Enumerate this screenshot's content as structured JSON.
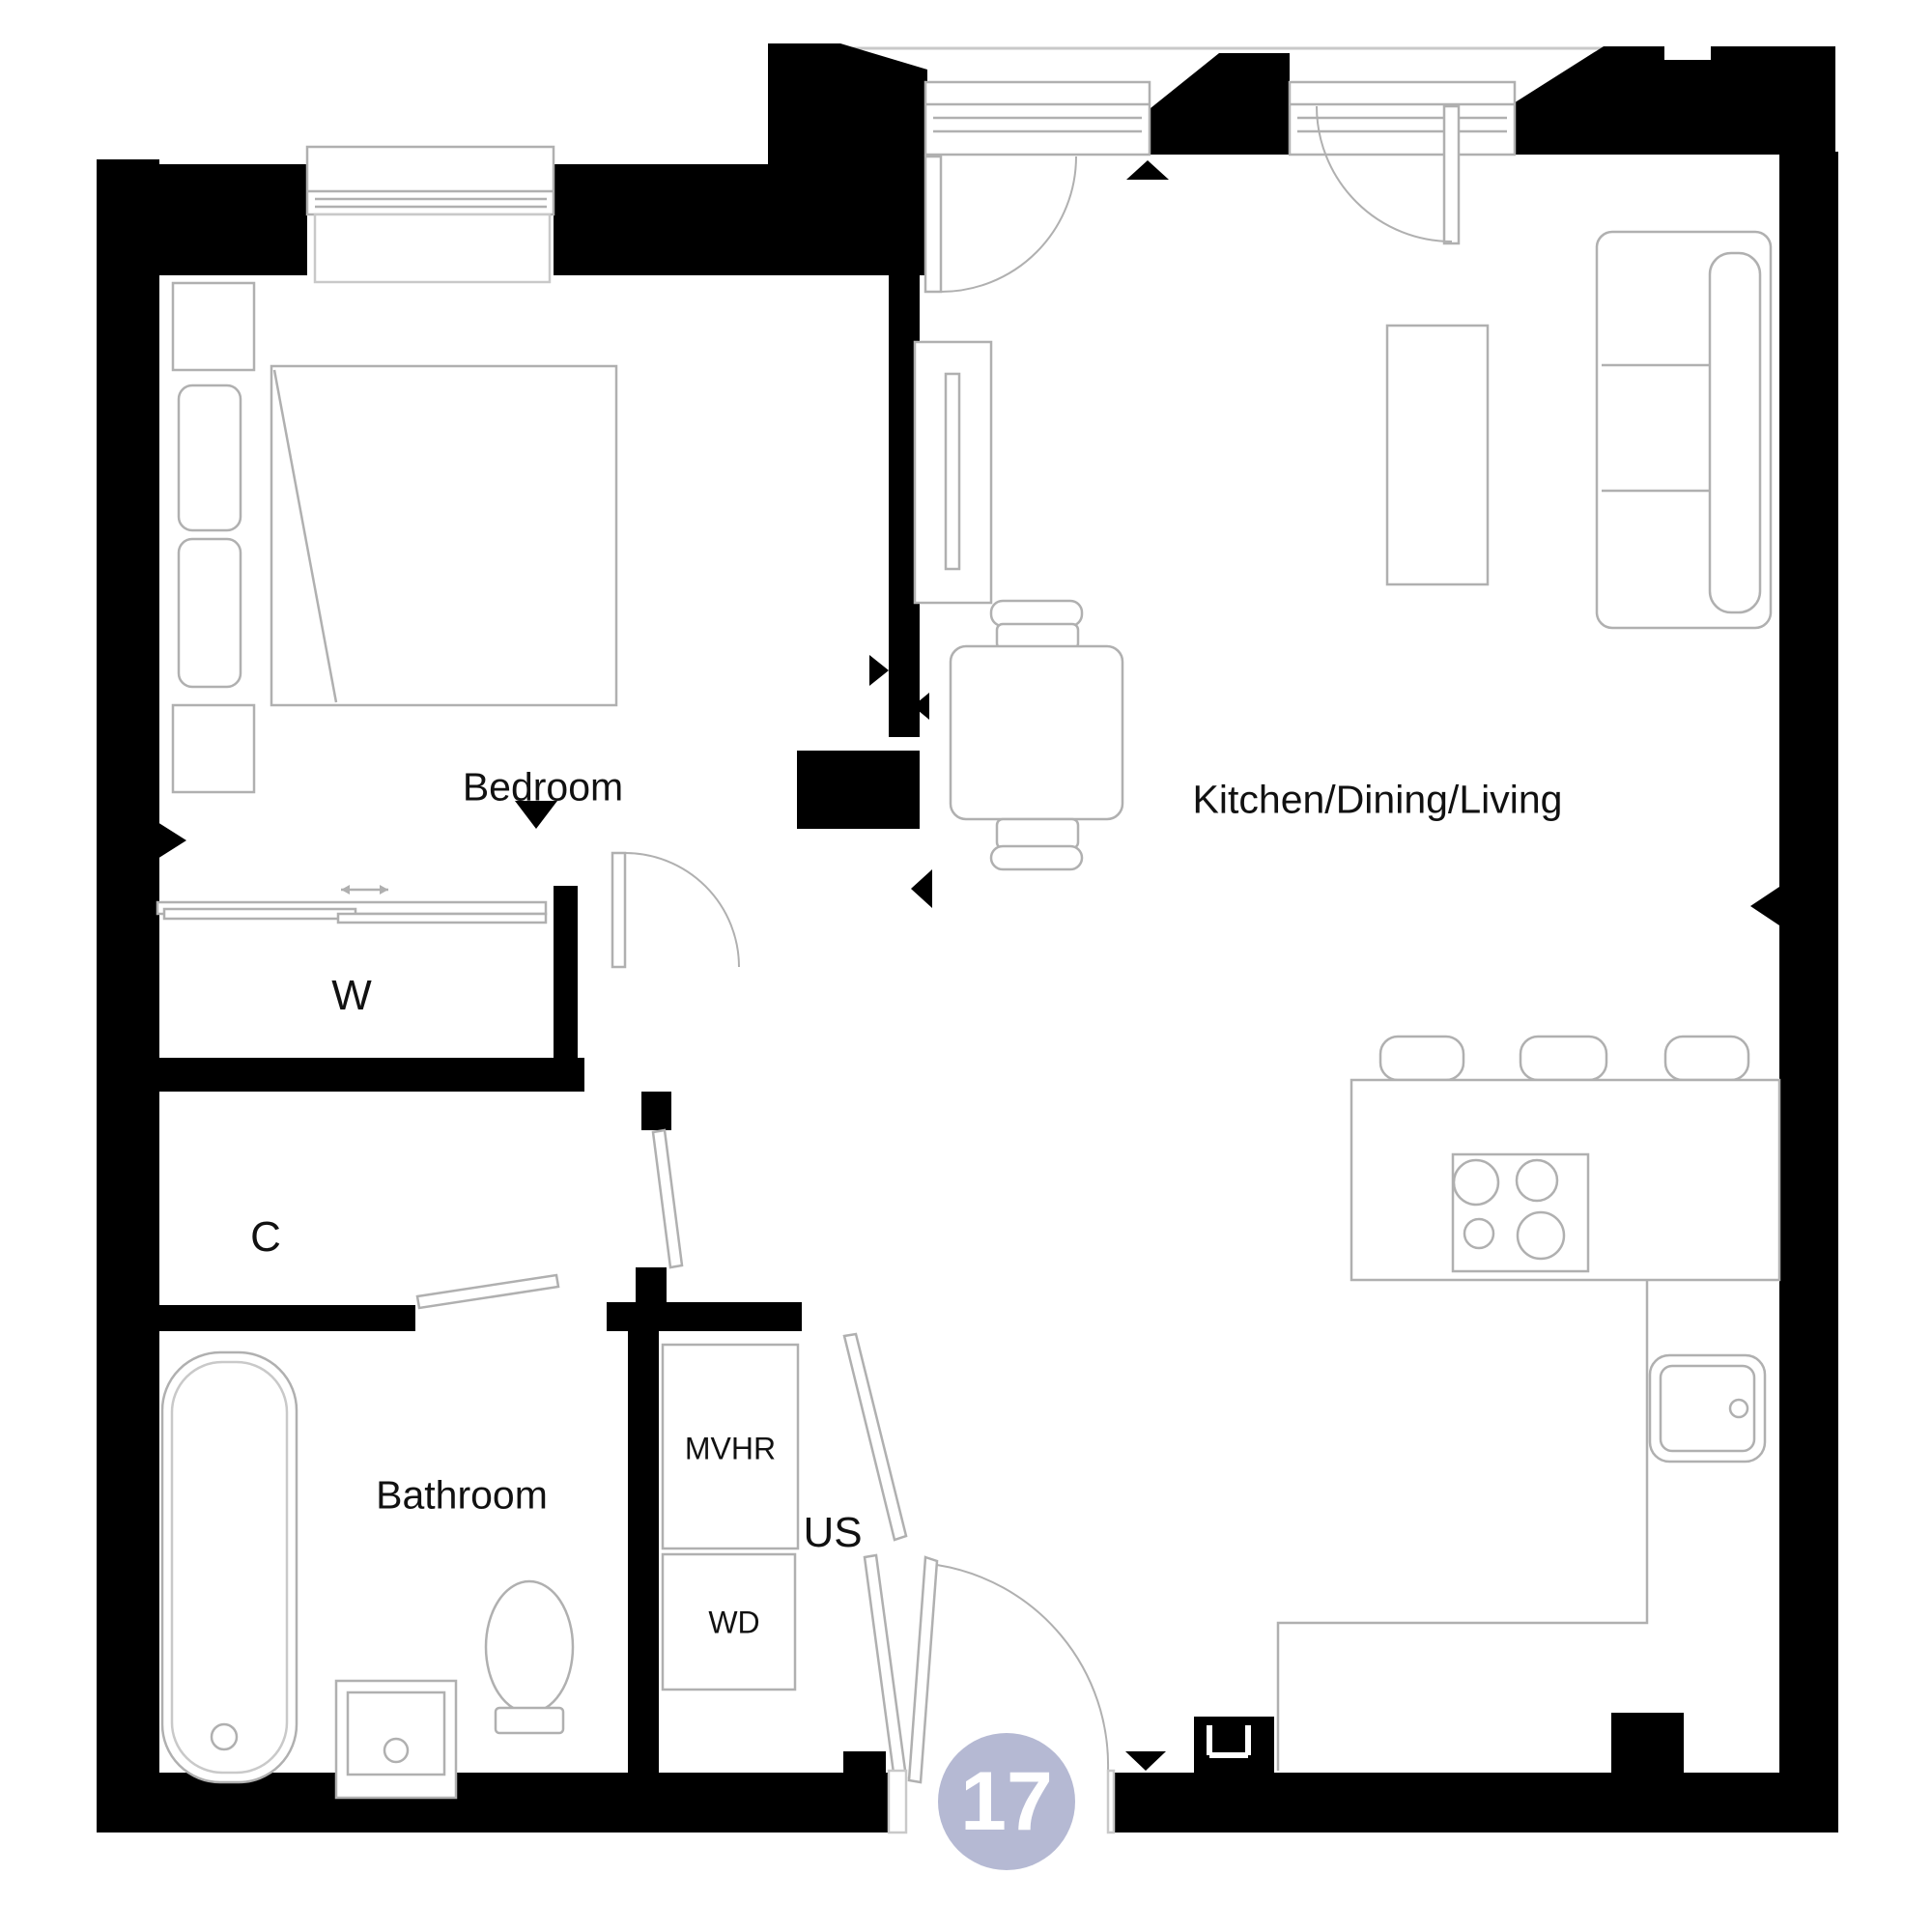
{
  "page": {
    "title": "Apartment floor plan",
    "background": "#ffffff"
  },
  "colors": {
    "wall": "#000000",
    "furniture_line": "#b0b0b0",
    "light_line": "#c9c9c9",
    "text": "#111111",
    "badge_fill": "#b5b9d3",
    "badge_text": "#ffffff"
  },
  "labels": {
    "bedroom": "Bedroom",
    "kitchen": "Kitchen/Dining/Living",
    "wardrobe": "W",
    "closet": "C",
    "bathroom": "Bathroom",
    "mvhr": "MVHR",
    "wd": "WD",
    "us": "US"
  },
  "unit": {
    "number": "17"
  },
  "legend": {
    "icons": [
      "window-icon",
      "door-swing-icon",
      "direction-triangle-icon",
      "bed-icon",
      "sofa-icon",
      "dining-table-icon",
      "hob-icon",
      "sink-icon",
      "bath-icon",
      "toilet-icon",
      "basin-icon",
      "radiator-icon",
      "sliding-wardrobe-icon",
      "unit-number-badge"
    ]
  }
}
